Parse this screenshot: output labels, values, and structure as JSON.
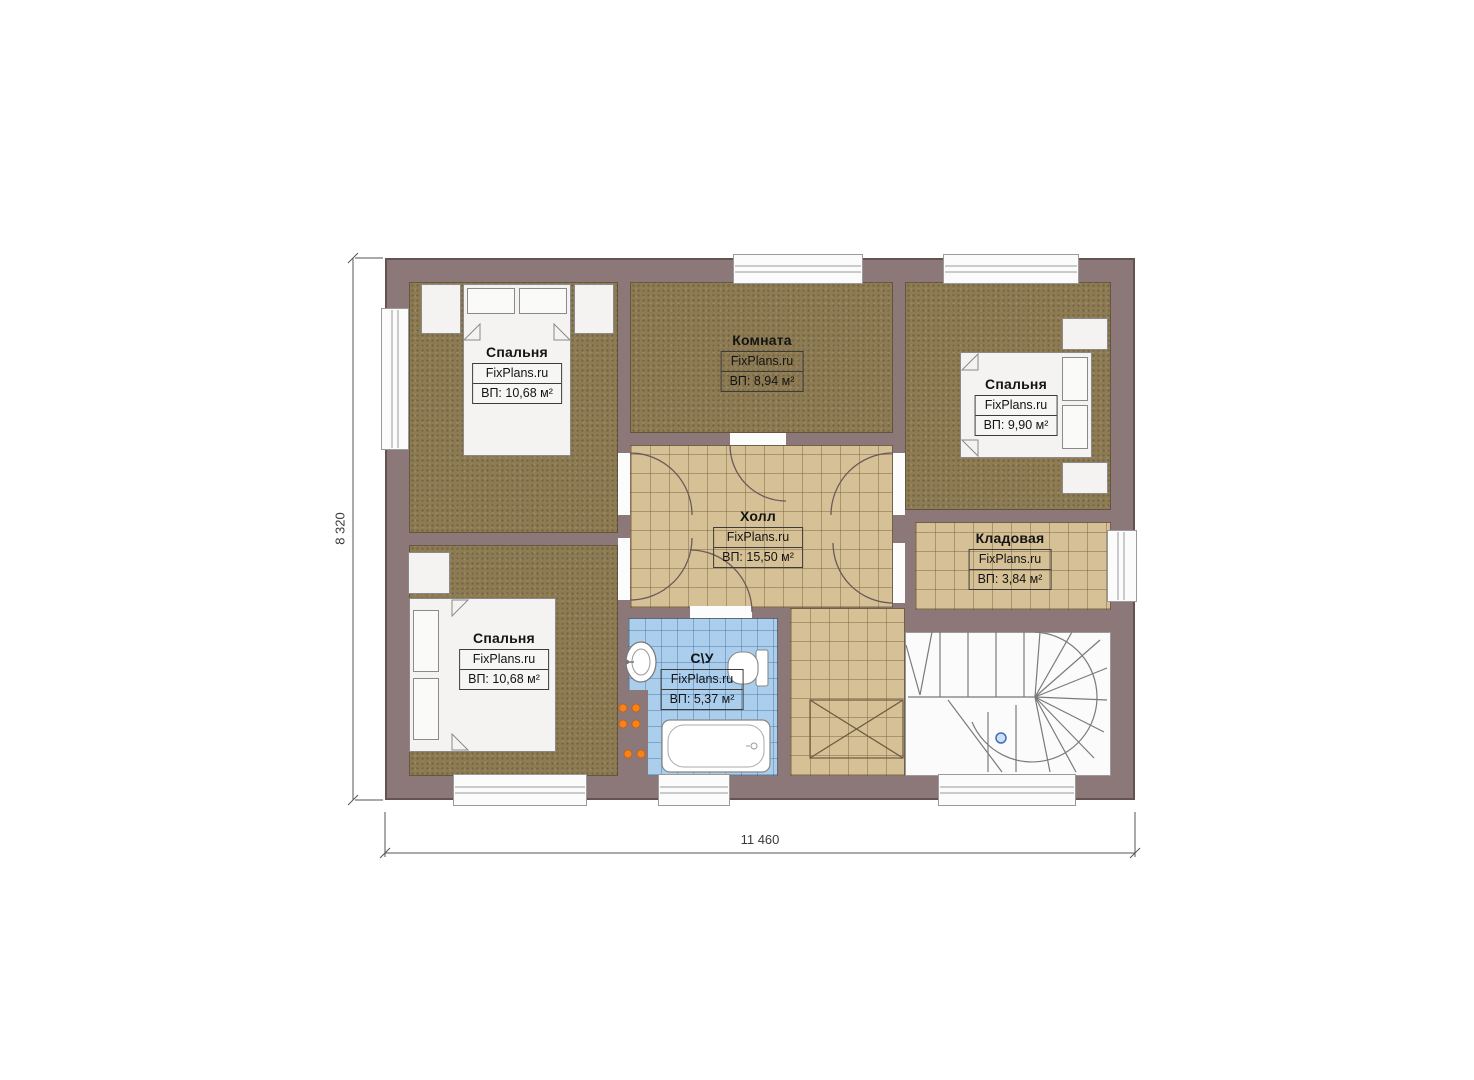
{
  "watermark": "FixPlans.ru",
  "dimensions": {
    "width": "11 460",
    "height": "8 320"
  },
  "rooms": {
    "bedroom_tl": {
      "name": "Спальня",
      "area": "ВП: 10,68 м²"
    },
    "room_top": {
      "name": "Комната",
      "area": "ВП: 8,94 м²"
    },
    "bedroom_tr": {
      "name": "Спальня",
      "area": "ВП: 9,90 м²"
    },
    "hall": {
      "name": "Холл",
      "area": "ВП: 15,50 м²"
    },
    "storage": {
      "name": "Кладовая",
      "area": "ВП: 3,84 м²"
    },
    "bedroom_bl": {
      "name": "Спальня",
      "area": "ВП: 10,68 м²"
    },
    "bathroom": {
      "name": "С\\У",
      "area": "ВП: 5,37 м²"
    }
  },
  "colors": {
    "wall": "#8c7878",
    "bedroom_floor": "#8d7b53",
    "tile_floor": "#d6c095",
    "bath_floor": "#aaceec",
    "radiator_orange": "#f5821f",
    "stair_marker_blue": "#3f6fb5"
  }
}
